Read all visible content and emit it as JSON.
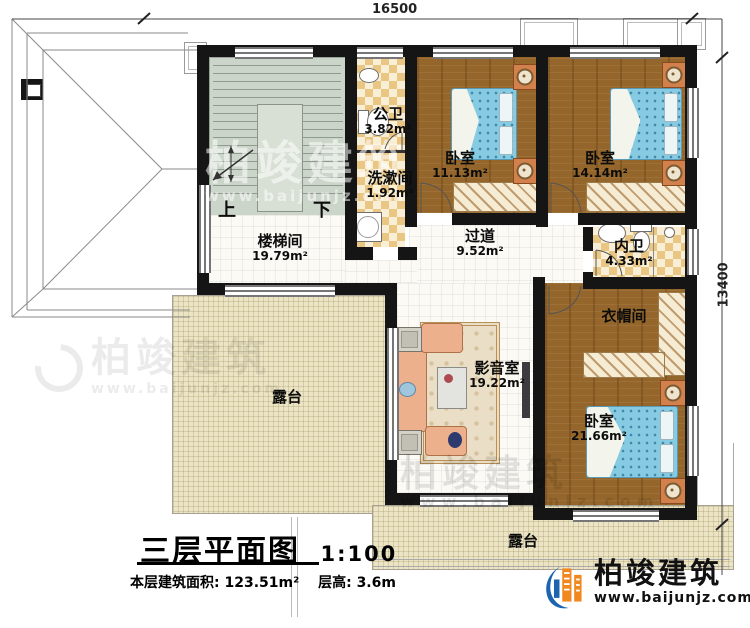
{
  "dimensions": {
    "top": "16500",
    "right": "13400"
  },
  "rooms": {
    "stairwell": {
      "name": "楼梯间",
      "area": "19.79m²"
    },
    "public_bath": {
      "name": "公卫",
      "area": "3.82m²"
    },
    "washroom": {
      "name": "洗漱间",
      "area": "1.92m²"
    },
    "bedroom1": {
      "name": "卧室",
      "area": "11.13m²"
    },
    "bedroom2": {
      "name": "卧室",
      "area": "14.14m²"
    },
    "corridor": {
      "name": "过道",
      "area": "9.52m²"
    },
    "ensuite": {
      "name": "内卫",
      "area": "4.33m²"
    },
    "cloakroom": {
      "name": "衣帽间"
    },
    "media_room": {
      "name": "影音室",
      "area": "19.22m²"
    },
    "bedroom3": {
      "name": "卧室",
      "area": "21.66m²"
    },
    "terrace_left": {
      "name": "露台"
    },
    "terrace_bottom": {
      "name": "露台"
    }
  },
  "stairs": {
    "up": "上",
    "down": "下"
  },
  "title": {
    "main": "三层平面图",
    "scale": "1:100",
    "area_text": "本层建筑面积: 123.51m²",
    "height_text": "层高: 3.6m"
  },
  "branding": {
    "company": "柏竣建筑",
    "website": "www.baijunjz.com"
  }
}
